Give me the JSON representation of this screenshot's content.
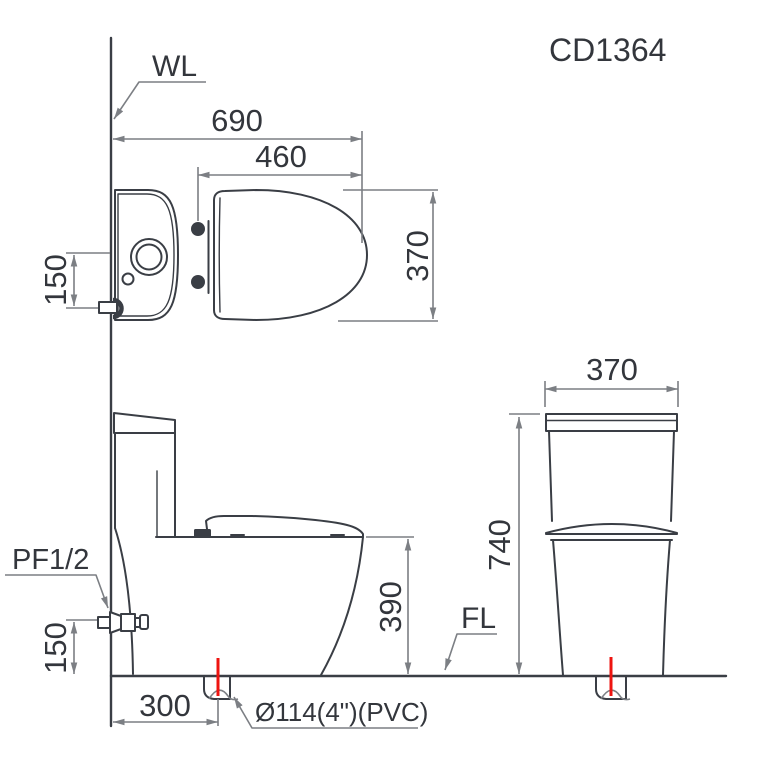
{
  "drawing": {
    "model_code": "CD1364",
    "labels": {
      "wall_line": "WL",
      "floor_line": "FL",
      "water_supply": "PF1/2",
      "drain_pipe": "Ø114(4\")(PVC)"
    },
    "dimensions": {
      "top_view": {
        "overall_length": "690",
        "seat_ring_length": "460",
        "overall_width": "370",
        "supply_offset_from_center": "150"
      },
      "side_view": {
        "bowl_rim_height": "390",
        "drain_rough_in": "300",
        "supply_height_above_floor": "150"
      },
      "front_view": {
        "tank_width": "370",
        "overall_height": "740"
      }
    },
    "colors": {
      "outline": "#3a3e45",
      "dimension_lines": "#7c7f84",
      "text": "#33363c",
      "drain_centerline_red": "#ee1410",
      "background": "#ffffff"
    }
  }
}
